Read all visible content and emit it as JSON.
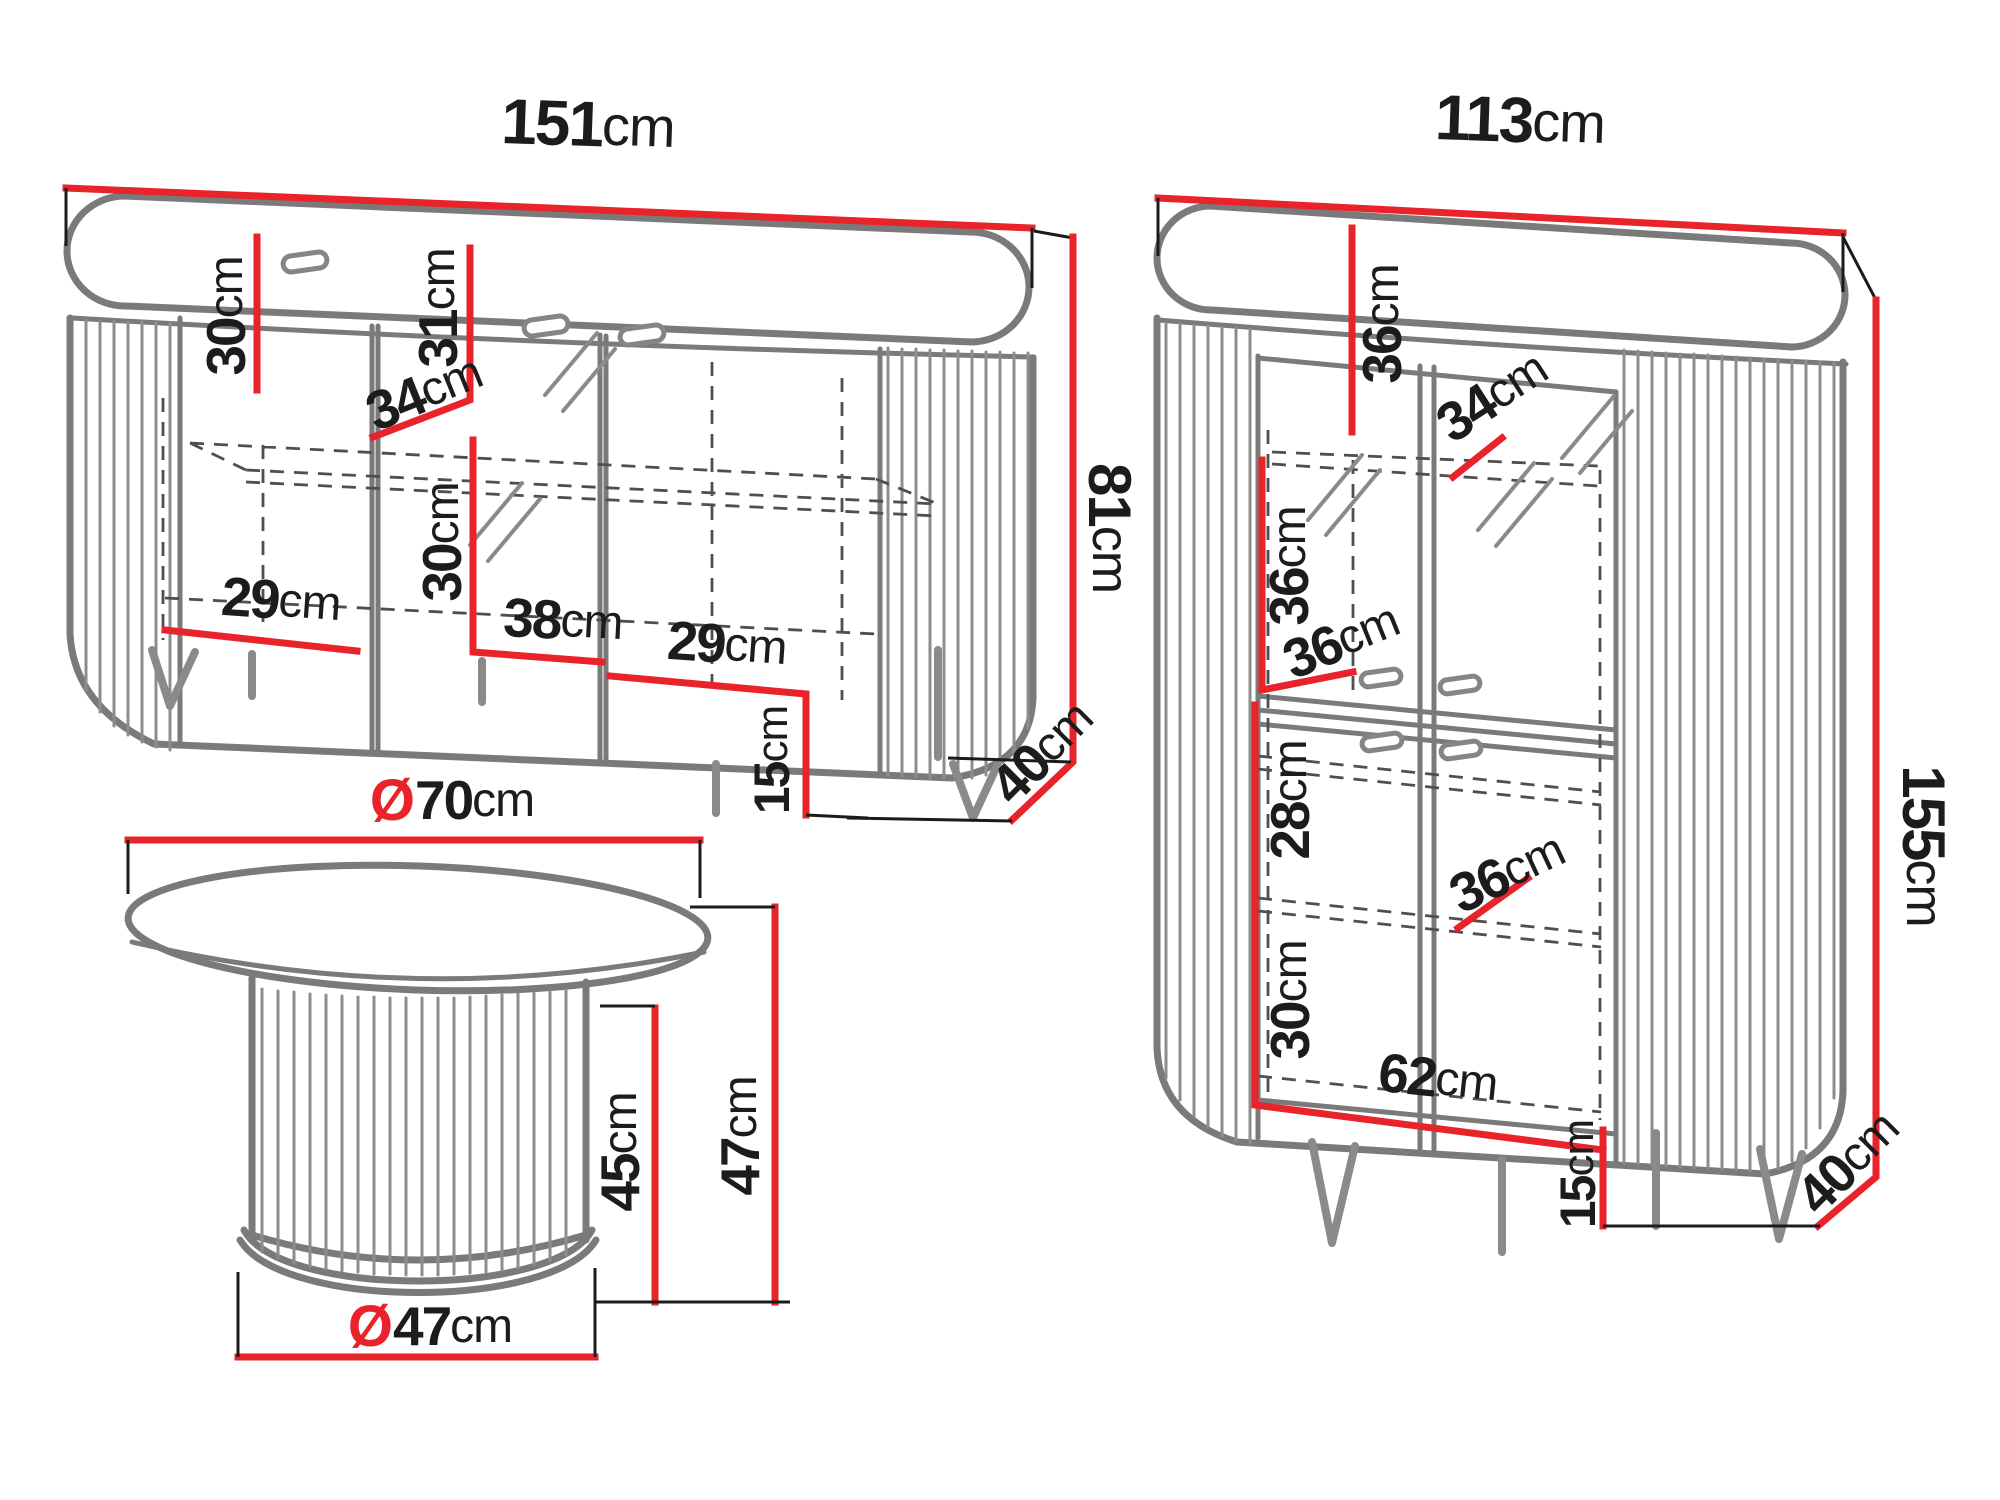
{
  "colors": {
    "dimension_red": "#e8232a",
    "line_gray": "#7a7a7a",
    "dash_gray": "#4f4f4f",
    "text_black": "#1c1c1c"
  },
  "sideboard": {
    "width": {
      "value": "151",
      "unit": "cm"
    },
    "total_height": {
      "value": "81",
      "unit": "cm"
    },
    "depth": {
      "value": "40",
      "unit": "cm"
    },
    "leg_height": {
      "value": "15",
      "unit": "cm"
    },
    "upper_section_height": {
      "value": "30",
      "unit": "cm"
    },
    "glass_section_upper_height": {
      "value": "31",
      "unit": "cm"
    },
    "shelf_depth": {
      "value": "34",
      "unit": "cm"
    },
    "glass_section_lower_height": {
      "value": "30",
      "unit": "cm"
    },
    "center_inner_width": {
      "value": "38",
      "unit": "cm"
    },
    "left_inner_width": {
      "value": "29",
      "unit": "cm"
    },
    "right_inner_width": {
      "value": "29",
      "unit": "cm"
    }
  },
  "cabinet": {
    "width": {
      "value": "113",
      "unit": "cm"
    },
    "total_height": {
      "value": "155",
      "unit": "cm"
    },
    "depth": {
      "value": "40",
      "unit": "cm"
    },
    "leg_height": {
      "value": "15",
      "unit": "cm"
    },
    "top_section_height": {
      "value": "36",
      "unit": "cm"
    },
    "shelf_depth": {
      "value": "34",
      "unit": "cm"
    },
    "upper_middle_section_height": {
      "value": "36",
      "unit": "cm"
    },
    "upper_inner_width": {
      "value": "36",
      "unit": "cm"
    },
    "lower_upper_section_height": {
      "value": "28",
      "unit": "cm"
    },
    "lower_shelf_width": {
      "value": "36",
      "unit": "cm"
    },
    "bottom_section_height": {
      "value": "30",
      "unit": "cm"
    },
    "bottom_inner_width": {
      "value": "62",
      "unit": "cm"
    }
  },
  "table": {
    "top_diameter": {
      "prefix": "Ø",
      "value": "70",
      "unit": "cm"
    },
    "base_diameter": {
      "prefix": "Ø",
      "value": "47",
      "unit": "cm"
    },
    "pedestal_height": {
      "value": "45",
      "unit": "cm"
    },
    "total_height": {
      "value": "47",
      "unit": "cm"
    }
  }
}
